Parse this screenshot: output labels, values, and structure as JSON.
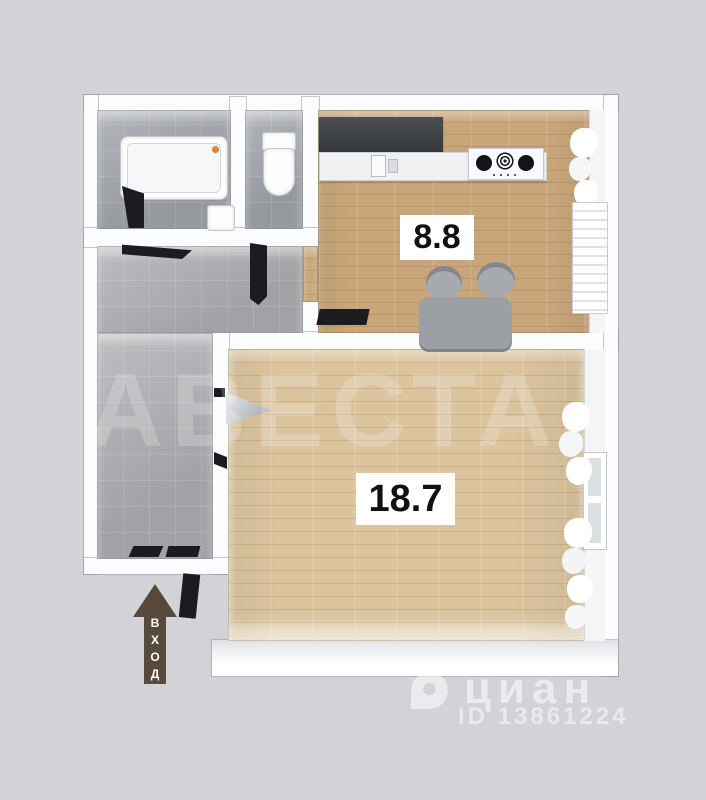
{
  "rooms": {
    "kitchen": {
      "area": "8.8"
    },
    "living_room": {
      "area": "18.7"
    }
  },
  "entrance": {
    "label": "ВХОД"
  },
  "watermarks": {
    "agency": "АВЕСТА",
    "brand": "циан",
    "listing_id": "ID 13861224"
  },
  "colors": {
    "background": "#d2d3d7",
    "wall": "#fbfcfd",
    "tile_floor": "#a9abae",
    "kitchen_floor": "#c9a67a",
    "living_floor": "#dbc49e",
    "dark_counter": "#3e4347",
    "dark_door": "#1b1c20",
    "furniture_gray": "#9b9ea2",
    "entrance_arrow": "#57493c",
    "area_label_bg": "#ffffff",
    "area_label_text": "#111111"
  }
}
